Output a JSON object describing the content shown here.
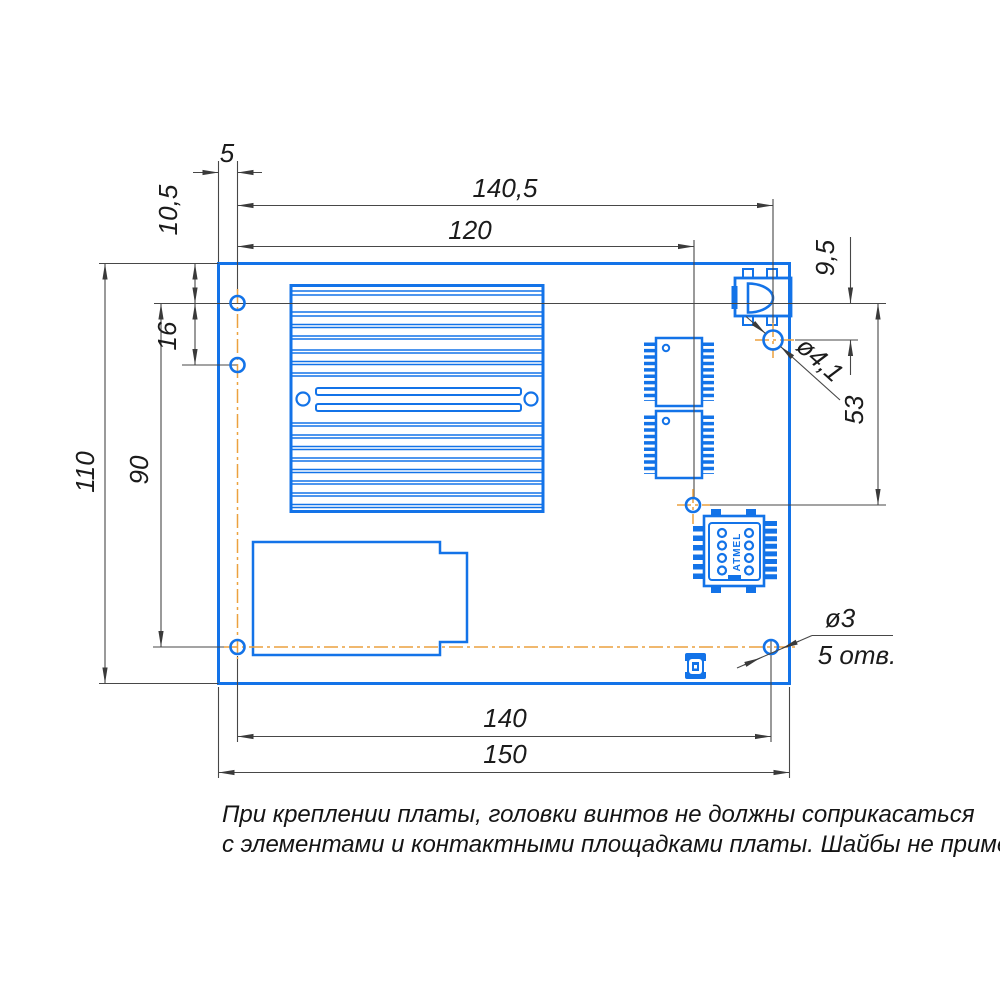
{
  "drawing": {
    "type": "PCB mounting drawing",
    "dimensions": {
      "dim_5": "5",
      "dim_140_5": "140,5",
      "dim_120": "120",
      "dim_10_5": "10,5",
      "dim_16": "16",
      "dim_110": "110",
      "dim_90": "90",
      "dim_9_5": "9,5",
      "dim_53": "53",
      "dim_dia_4_1": "ø4,1",
      "dim_dia_3": "ø3",
      "dim_hole_count": "5 отв.",
      "dim_140": "140",
      "dim_150": "150"
    },
    "components": {
      "sim_label": "ATMEL"
    },
    "note": {
      "line1": "При креплении платы, головки винтов не должны соприкасаться",
      "line2": "с элементами и контактными площадками платы. Шайбы не применять."
    },
    "colors": {
      "outline_blue": "#1373e8",
      "centerline_orange": "#eca13f",
      "dimension_gray": "#474747",
      "text_black": "#1b1b1b"
    }
  }
}
